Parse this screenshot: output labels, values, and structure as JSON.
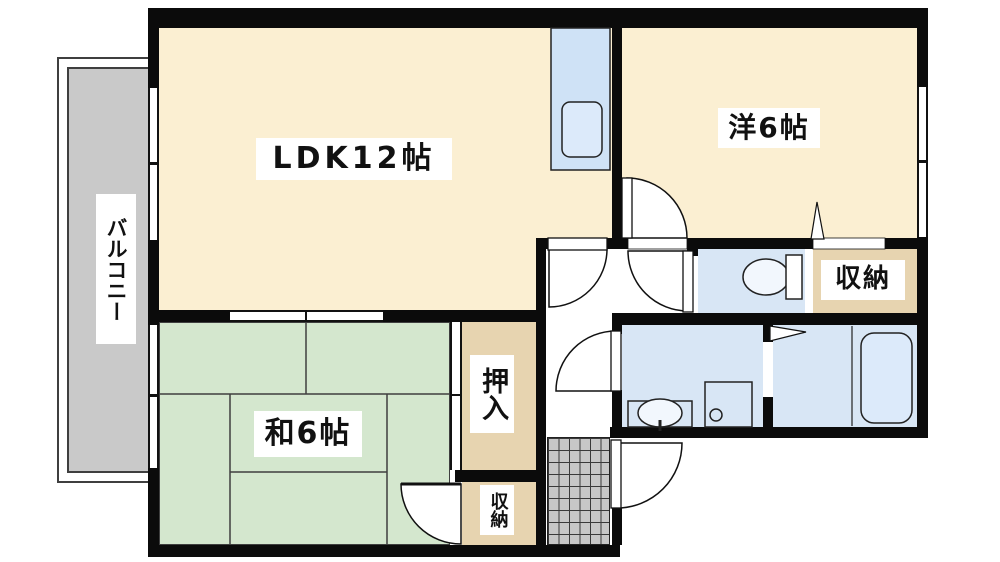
{
  "floorplan": {
    "balcony": {
      "label": "バルコニー"
    },
    "ldk": {
      "label": "LDK12帖"
    },
    "western_room": {
      "label": "洋6帖"
    },
    "japanese_room": {
      "label": "和6帖"
    },
    "oshiire": {
      "label": "押入"
    },
    "storage_upper": {
      "label": "収納"
    },
    "storage_lower": {
      "label": "収納"
    }
  },
  "fixtures": [
    "kitchen-counter",
    "kitchen-sink",
    "toilet",
    "washbasin",
    "washing-machine-pan",
    "bathtub",
    "entrance-tiles",
    "folding-door",
    "hinged-doors",
    "windows",
    "sliding-doors"
  ],
  "colors": {
    "room_cream": "#FBEFD2",
    "tatami_green": "#D4E7CE",
    "storage_beige": "#E7D4B0",
    "wet_area_blue": "#D8E6F5",
    "fixture_blue": "#DCEAFA",
    "balcony_gray": "#C9C9C9",
    "tile_gray": "#C7C7C7",
    "wall_black": "#0B0B0B"
  }
}
